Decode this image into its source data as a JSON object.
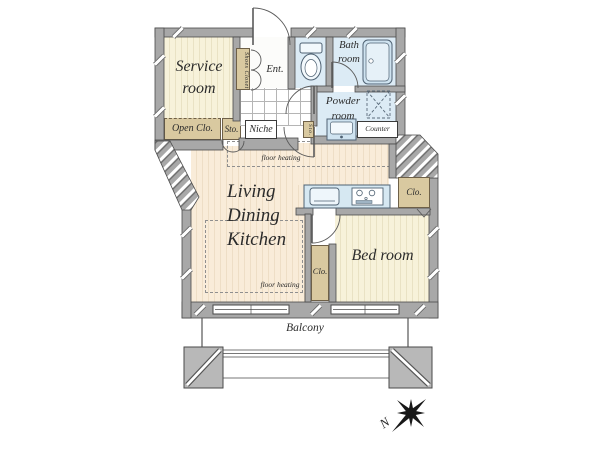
{
  "labels": {
    "service_1": "Service",
    "service_2": "room",
    "ldk_1": "Living",
    "ldk_2": "Dining",
    "ldk_3": "Kitchen",
    "bedroom": "Bed room",
    "bath_1": "Bath",
    "bath_2": "room",
    "powder_1": "Powder",
    "powder_2": "room",
    "ent": "Ent.",
    "open_clo": "Open Clo.",
    "sto": "Sto.",
    "niche": "Niche",
    "shoes_closet": "Shoes Closet",
    "sto_mini": "Sto.",
    "clo_bedroom": "Clo.",
    "clo_mid": "Clo.",
    "counter": "Counter",
    "floor_heating_top": "floor heating",
    "floor_heating_bottom": "floor heating",
    "balcony": "Balcony",
    "north": "N"
  },
  "colors": {
    "wall": "#a8a8a8",
    "wall_outline": "#4a4a4a",
    "wood_cream": "#f7f2da",
    "wood_peach": "#f9ecd9",
    "wet_blue": "#dcebf5",
    "closet_tan": "#d9c9a0",
    "text": "#2b2b2b",
    "compass": "#181818"
  }
}
